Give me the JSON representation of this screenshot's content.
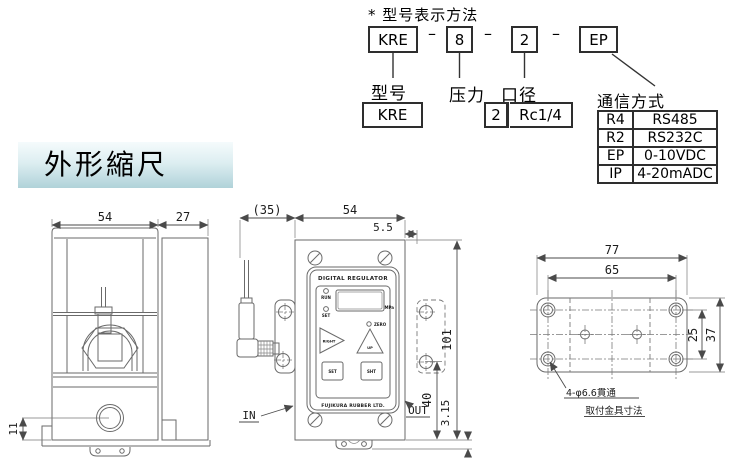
{
  "model_designation": {
    "title": "* 型号表示方法",
    "dash": "–",
    "boxes": {
      "model": "KRE",
      "pressure": "8",
      "bore": "2",
      "comm": "EP"
    },
    "labels": {
      "model": "型号",
      "pressure": "压力",
      "bore": "口径",
      "comm": "通信方式"
    },
    "model_value": "KRE",
    "bore_size": "2",
    "bore_thread": "Rc1/4",
    "comm_table": [
      {
        "code": "R4",
        "name": "RS485"
      },
      {
        "code": "R2",
        "name": "RS232C"
      },
      {
        "code": "EP",
        "name": "0-10VDC"
      },
      {
        "code": "IP",
        "name": "4-20mADC"
      }
    ]
  },
  "section_header": {
    "title": "外形縮尺"
  },
  "side_view": {
    "dim_width": "54",
    "dim_depth": "27",
    "dim_port": "11"
  },
  "front_view": {
    "dim_bracket": "(35)",
    "dim_width": "54",
    "dim_edge": "5.5",
    "dim_height": "101",
    "dim_out": "40",
    "dim_base": "3.15",
    "label_in": "IN",
    "label_out": "OUT",
    "panel": {
      "title": "DIGITAL REGULATOR",
      "maker": "FUJIKURA RUBBER LTD.",
      "led_run": "RUN",
      "led_set": "SET",
      "led_zero": "ZERO",
      "unit": "MPa",
      "key_right": "RIGHT",
      "key_up": "UP",
      "key_set": "SET",
      "key_shift": "SHT"
    }
  },
  "bracket_view": {
    "dim_width": "77",
    "dim_holes": "65",
    "dim_pitch": "25",
    "dim_height": "37",
    "note": "4-φ6.6貫通",
    "caption": "取付金具寸法"
  },
  "colors": {
    "header_gradient_top": "#f5fbfc",
    "header_gradient_bottom": "#b0d2d9",
    "drawing_line": "#6a6a6a",
    "text": "#111111"
  }
}
